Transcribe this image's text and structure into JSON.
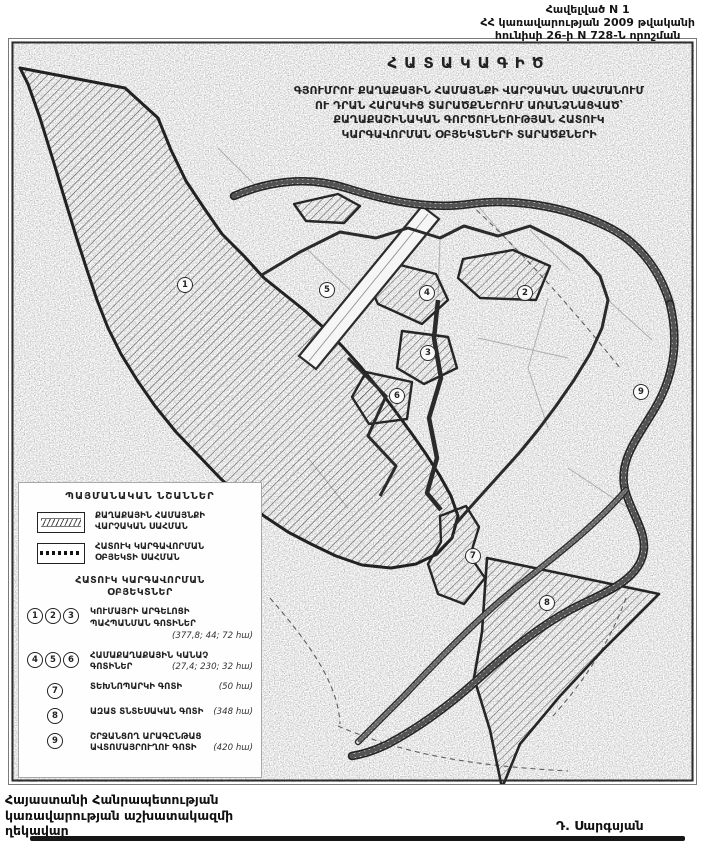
{
  "header": {
    "line1": "Հավելված N 1",
    "line2": "ՀՀ կառավարության 2009 թվականի",
    "line3": "հունիսի 26-ի N 728-Ն որոշման"
  },
  "map": {
    "plan_label": "ՀԱՏԱԿԱԳԻԾ",
    "title_lines": [
      "ԳՅՈՒՄՐՈՒ ՔԱՂԱՔԱՅԻՆ ՀԱՄԱՅՆՔԻ ՎԱՐՉԱԿԱՆ ՍԱՀՄԱՆՈՒՄ",
      "ՈՒ ԴՐԱՆ ՀԱՐԱԿԻՑ ՏԱՐԱԾՔՆԵՐՈՒՄ ԱՌԱՆՁՆԱՑՎԱԾ՝",
      "ՔԱՂԱՔԱՇԻՆԱԿԱՆ ԳՈՐԾՈՒՆԵՈՒԹՅԱՆ ՀԱՏՈՒԿ",
      "ԿԱՐԳԱՎՈՐՄԱՆ ՕԲՅԵԿՏՆԵՐԻ ՏԱՐԱԾՔՆԵՐԻ"
    ],
    "markers": [
      {
        "n": "1",
        "x": 177,
        "y": 247
      },
      {
        "n": "5",
        "x": 319,
        "y": 252
      },
      {
        "n": "4",
        "x": 419,
        "y": 255
      },
      {
        "n": "2",
        "x": 517,
        "y": 255
      },
      {
        "n": "3",
        "x": 420,
        "y": 315
      },
      {
        "n": "6",
        "x": 389,
        "y": 358
      },
      {
        "n": "9",
        "x": 633,
        "y": 354
      },
      {
        "n": "7",
        "x": 465,
        "y": 518
      },
      {
        "n": "8",
        "x": 539,
        "y": 565
      }
    ]
  },
  "legend": {
    "title": "ՊԱՅՄԱՆԱԿԱՆ ՆՇԱՆՆԵՐ",
    "boundary_items": [
      {
        "label_lines": [
          "ՔԱՂԱՔԱՅԻՆ ՀԱՄԱՅՆՔԻ",
          "ՎԱՐՉԱԿԱՆ ՍԱՀՄԱՆ"
        ]
      },
      {
        "label_lines": [
          "ՀԱՏՈՒԿ ԿԱՐԳԱՎՈՐՄԱՆ",
          "ՕԲՅԵԿՏԻ ՍԱՀՄԱՆ"
        ]
      }
    ],
    "objects_title_lines": [
      "ՀԱՏՈՒԿ ԿԱՐԳԱՎՈՐՄԱՆ",
      "ՕԲՅԵԿՏՆԵՐ"
    ],
    "objects": [
      {
        "numbers": [
          "1",
          "2",
          "3"
        ],
        "label_lines": [
          "ԿՈՒՄԱՅՐԻ ԱՐԳԵԼՈՑԻ",
          "ՊԱՀՊԱՆՄԱՆ ԳՈՏԻՆԵՐ"
        ],
        "value": "(377,8; 44; 72 հա)"
      },
      {
        "numbers": [
          "4",
          "5",
          "6"
        ],
        "label_lines": [
          "ՀԱՄԱՔԱՂԱՔԱՅԻՆ ԿԱՆԱՉ",
          "ԳՈՏԻՆԵՐ"
        ],
        "value": "(27,4; 230; 32 հա)"
      },
      {
        "numbers": [
          "7"
        ],
        "label_lines": [
          "ՏԵԽՆՈՊԱՐԿԻ ԳՈՏԻ"
        ],
        "value": "(50 հա)"
      },
      {
        "numbers": [
          "8"
        ],
        "label_lines": [
          "ԱԶԱՏ ՏՆՏԵՍԱԿԱՆ ԳՈՏԻ"
        ],
        "value": "(348 հա)"
      },
      {
        "numbers": [
          "9"
        ],
        "label_lines": [
          "ՇՐՋԱՆՑՈՂ ԱՐԱԳԸՆԹԱՑ",
          "ԱՎՏՈՄԱՅՐՈՒՂՈՒ ԳՈՏԻ"
        ],
        "value": "(420 հա)"
      }
    ]
  },
  "footer": {
    "left_lines": [
      "Հայաստանի Հանրապետության",
      "կառավարության աշխատակազմի",
      "ղեկավար"
    ],
    "signature": "Դ. Սարգսյան"
  },
  "colors": {
    "ink": "#1a1a1a",
    "paper": "#ffffff",
    "scan_gray": "#8a8a8a"
  }
}
